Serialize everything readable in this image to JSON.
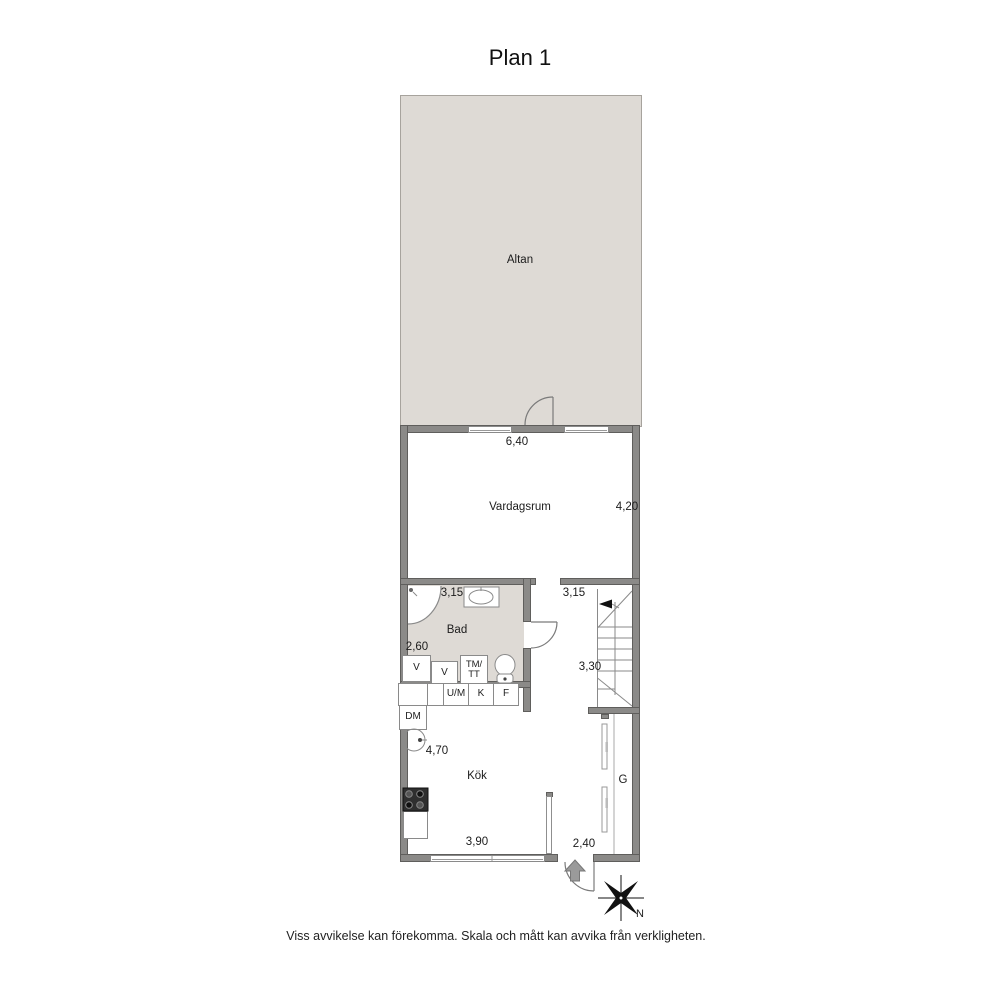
{
  "title": "Plan 1",
  "rooms": {
    "altan": {
      "label": "Altan"
    },
    "vardagsrum": {
      "label": "Vardagsrum",
      "width": "6,40",
      "depth": "4,20"
    },
    "bad": {
      "label": "Bad",
      "width": "3,15",
      "depth": "2,60"
    },
    "stairs": {
      "width": "3,15",
      "depth": "3,30"
    },
    "kok": {
      "label": "Kök",
      "depth": "4,70",
      "width": "3,90"
    },
    "entre": {
      "width": "2,40"
    },
    "garderob": {
      "label": "G"
    }
  },
  "fixtures": {
    "v_left": "V",
    "v_right": "V",
    "tm": "TM/",
    "tt": "TT",
    "um": "U/M",
    "k": "K",
    "f": "F",
    "dm": "DM"
  },
  "compass": {
    "north": "N"
  },
  "disclaimer": "Viss avvikelse kan förekomma. Skala och mått kan avvika från verkligheten."
}
